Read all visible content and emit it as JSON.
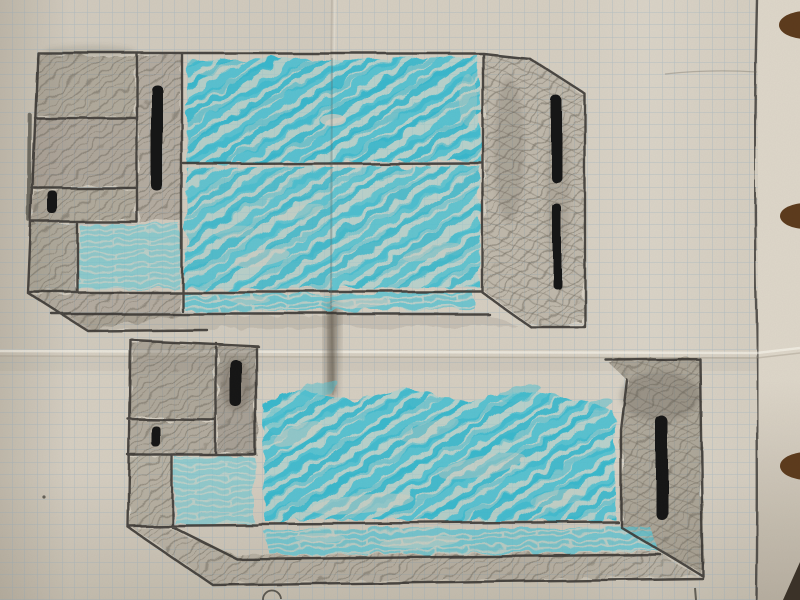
{
  "scene": {
    "type": "photograph",
    "subject": "Hand-drawn furniture sketches on squared graph paper, coloured with turquoise marker and grey pencil",
    "paper": {
      "kind": "squared graph paper page from a workbook",
      "grid_square_px": 12.5,
      "margin": "vertical pencil margin line near the right edge, plain strip beyond it",
      "binder_holes": 3,
      "creases": [
        "horizontal fold across the middle of the page",
        "vertical fold left of centre with a dark smudge where it crosses the drawings"
      ],
      "extra_marks": [
        "faint stray pencil line near top right margin",
        "tiny pencil dot left of the lower sketch",
        "small pencil circle cut off at the bottom edge",
        "short pencil tick below the lower sketch base"
      ]
    },
    "sketches": [
      {
        "id": "top-cabinet",
        "position": "upper half of page",
        "description": "Perspective sketch of a wide cabinet: pencil-shaded left section with stacked panels, tall narrow shaded door with long black handle, two large turquoise marker doors, small light-turquoise panel, turquoise kick strip and shaded right side panel with two black handles",
        "turquoise_doors": 2,
        "handles": 4
      },
      {
        "id": "bottom-cabinet",
        "position": "lower half of page",
        "description": "Similar perspective sketch: pencil-shaded head section with one long and one short black handle, large turquoise marker body, light turquoise lower panels, turquoise kick strip, shaded right end panel with one long black handle, perspective plinth base",
        "turquoise_doors": 1,
        "handles": 3
      }
    ]
  },
  "colors": {
    "paper": "#d5cec1",
    "paper_light": "#ddd6c9",
    "paper_dark": "#b7b0a3",
    "grid_line": "#7fa3c0",
    "pencil_line": "#383630",
    "pencil_shade": "#6e675b",
    "marker_black": "#191817",
    "cyan_strong": "#2db5cc",
    "cyan_mid": "#4fc0d0",
    "cyan_light": "#9ad4d6",
    "hole_brown": "#5d3b1d",
    "table_dark": "#3b3228",
    "crease_shadow": "#8a8170"
  }
}
